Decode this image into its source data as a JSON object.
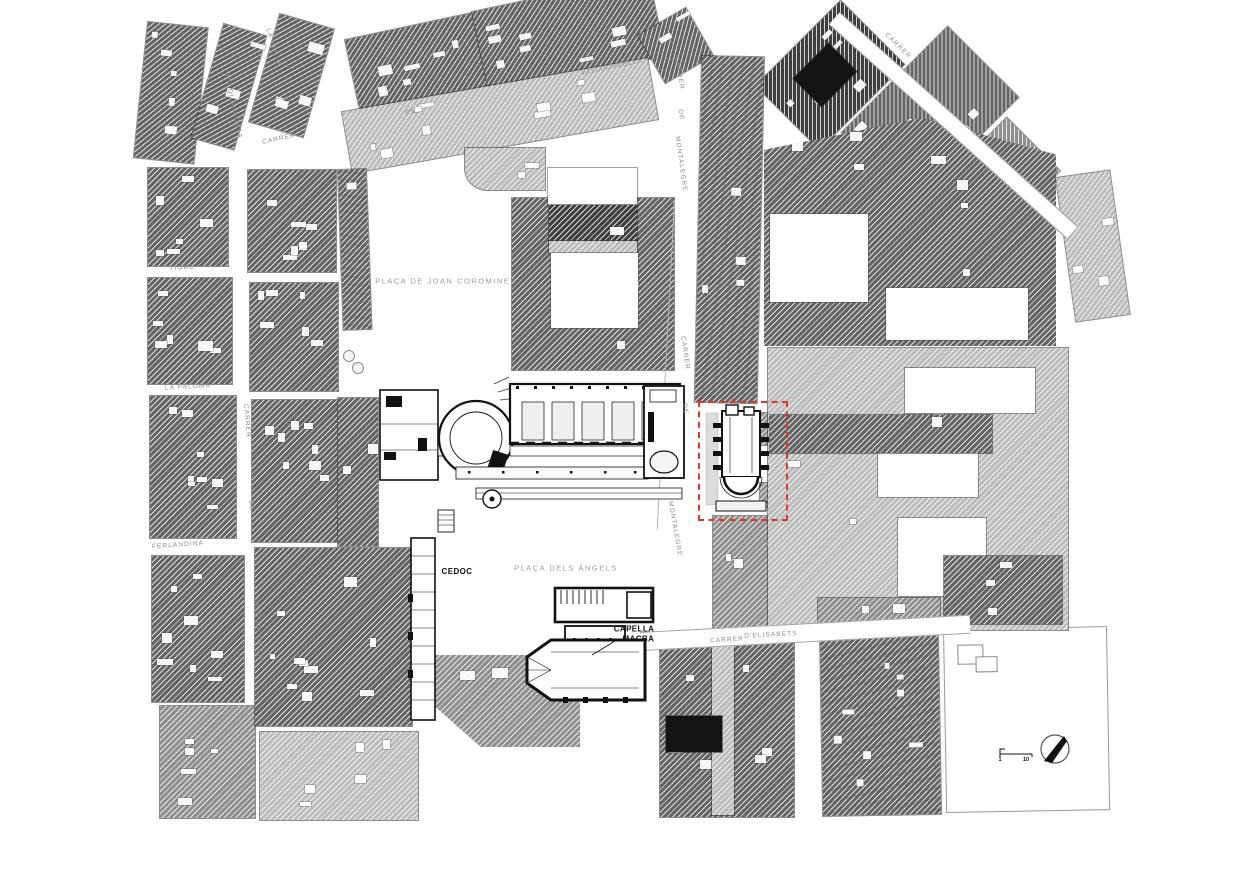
{
  "map": {
    "description": "Urban site plan of the MACBA / Plaça dels Àngels area, Barcelona",
    "labels": [
      {
        "name": "street-label-la-verge",
        "text": "LA VERGE",
        "x": 274,
        "y": 48,
        "rot": 72,
        "cls": "street"
      },
      {
        "name": "street-label-carrer-valldonzella-1",
        "text": "CARRER",
        "x": 279,
        "y": 139,
        "rot": -12,
        "cls": "street"
      },
      {
        "name": "street-label-carrer-valldonzella-2",
        "text": "DE",
        "x": 411,
        "y": 112,
        "rot": -12,
        "cls": "street"
      },
      {
        "name": "street-label-carrer-valldonzella-3",
        "text": "VALLDONZELLA",
        "x": 612,
        "y": 67,
        "rot": -12,
        "cls": "street"
      },
      {
        "name": "street-label-joaquin-costa-upper",
        "text": "JOAQUÍN COSTA",
        "x": 233,
        "y": 106,
        "rot": 78,
        "cls": "street"
      },
      {
        "name": "street-label-tigre",
        "text": "TIGRE",
        "x": 182,
        "y": 268,
        "rot": -3,
        "cls": "street"
      },
      {
        "name": "street-label-la-paloma",
        "text": "LA PALOMA",
        "x": 188,
        "y": 387,
        "rot": -3,
        "cls": "street"
      },
      {
        "name": "street-label-carrer-jc-1",
        "text": "CARRER",
        "x": 247,
        "y": 421,
        "rot": 85,
        "cls": "street"
      },
      {
        "name": "street-label-carrer-jc-2",
        "text": "DE",
        "x": 251,
        "y": 506,
        "rot": 85,
        "cls": "street"
      },
      {
        "name": "street-label-joaquin-costa-lower",
        "text": "JOAQUÍN COSTA",
        "x": 258,
        "y": 630,
        "rot": 85,
        "cls": "street"
      },
      {
        "name": "street-label-ferlandina",
        "text": "FERLANDINA",
        "x": 178,
        "y": 545,
        "rot": -4,
        "cls": "street"
      },
      {
        "name": "street-label-montalegre-1",
        "text": "CARRER",
        "x": 679,
        "y": 73,
        "rot": 80,
        "cls": "street"
      },
      {
        "name": "street-label-montalegre-2",
        "text": "DE",
        "x": 681,
        "y": 115,
        "rot": 80,
        "cls": "street"
      },
      {
        "name": "street-label-montalegre-3",
        "text": "MONTALEGRE",
        "x": 681,
        "y": 164,
        "rot": 82,
        "cls": "street"
      },
      {
        "name": "street-label-montalegre-4",
        "text": "CARRER",
        "x": 685,
        "y": 353,
        "rot": 82,
        "cls": "street"
      },
      {
        "name": "street-label-montalegre-5",
        "text": "DE",
        "x": 685,
        "y": 409,
        "rot": 82,
        "cls": "street"
      },
      {
        "name": "street-label-montalegre-6",
        "text": "MONTALEGRE",
        "x": 675,
        "y": 529,
        "rot": 80,
        "cls": "street"
      },
      {
        "name": "street-label-carrer-top-right",
        "text": "CARRER",
        "x": 898,
        "y": 46,
        "rot": 44,
        "cls": "street"
      },
      {
        "name": "street-label-elisabets-1",
        "text": "CARRER",
        "x": 727,
        "y": 640,
        "rot": -3,
        "cls": "street"
      },
      {
        "name": "street-label-elisabets-2",
        "text": "D'ELISABETS",
        "x": 771,
        "y": 635,
        "rot": -3,
        "cls": "street"
      },
      {
        "name": "place-label-joan-coromines",
        "text": "PLAÇA DE JOAN COROMINES",
        "x": 446,
        "y": 281,
        "rot": 0,
        "cls": "place"
      },
      {
        "name": "place-label-placa-dels-angels",
        "text": "PLAÇA DELS ÀNGELS",
        "x": 566,
        "y": 568,
        "rot": 0,
        "cls": "place"
      },
      {
        "name": "building-label-cedoc",
        "text": "CEDOC",
        "x": 457,
        "y": 572,
        "rot": 0,
        "cls": "building"
      },
      {
        "name": "building-label-capella-macba",
        "text": "CAPELLA\nMACBA",
        "x": 634,
        "y": 634,
        "rot": 0,
        "cls": "building"
      }
    ],
    "scale_bar": {
      "start": "1",
      "end": "10"
    },
    "colors": {
      "highlight_red": "#D93A2B",
      "block_dark": "#646464",
      "block_darker": "#3f3f3f",
      "block_medium": "#8f8f8f",
      "block_light": "#bcbcbc",
      "ink": "#111111"
    }
  }
}
